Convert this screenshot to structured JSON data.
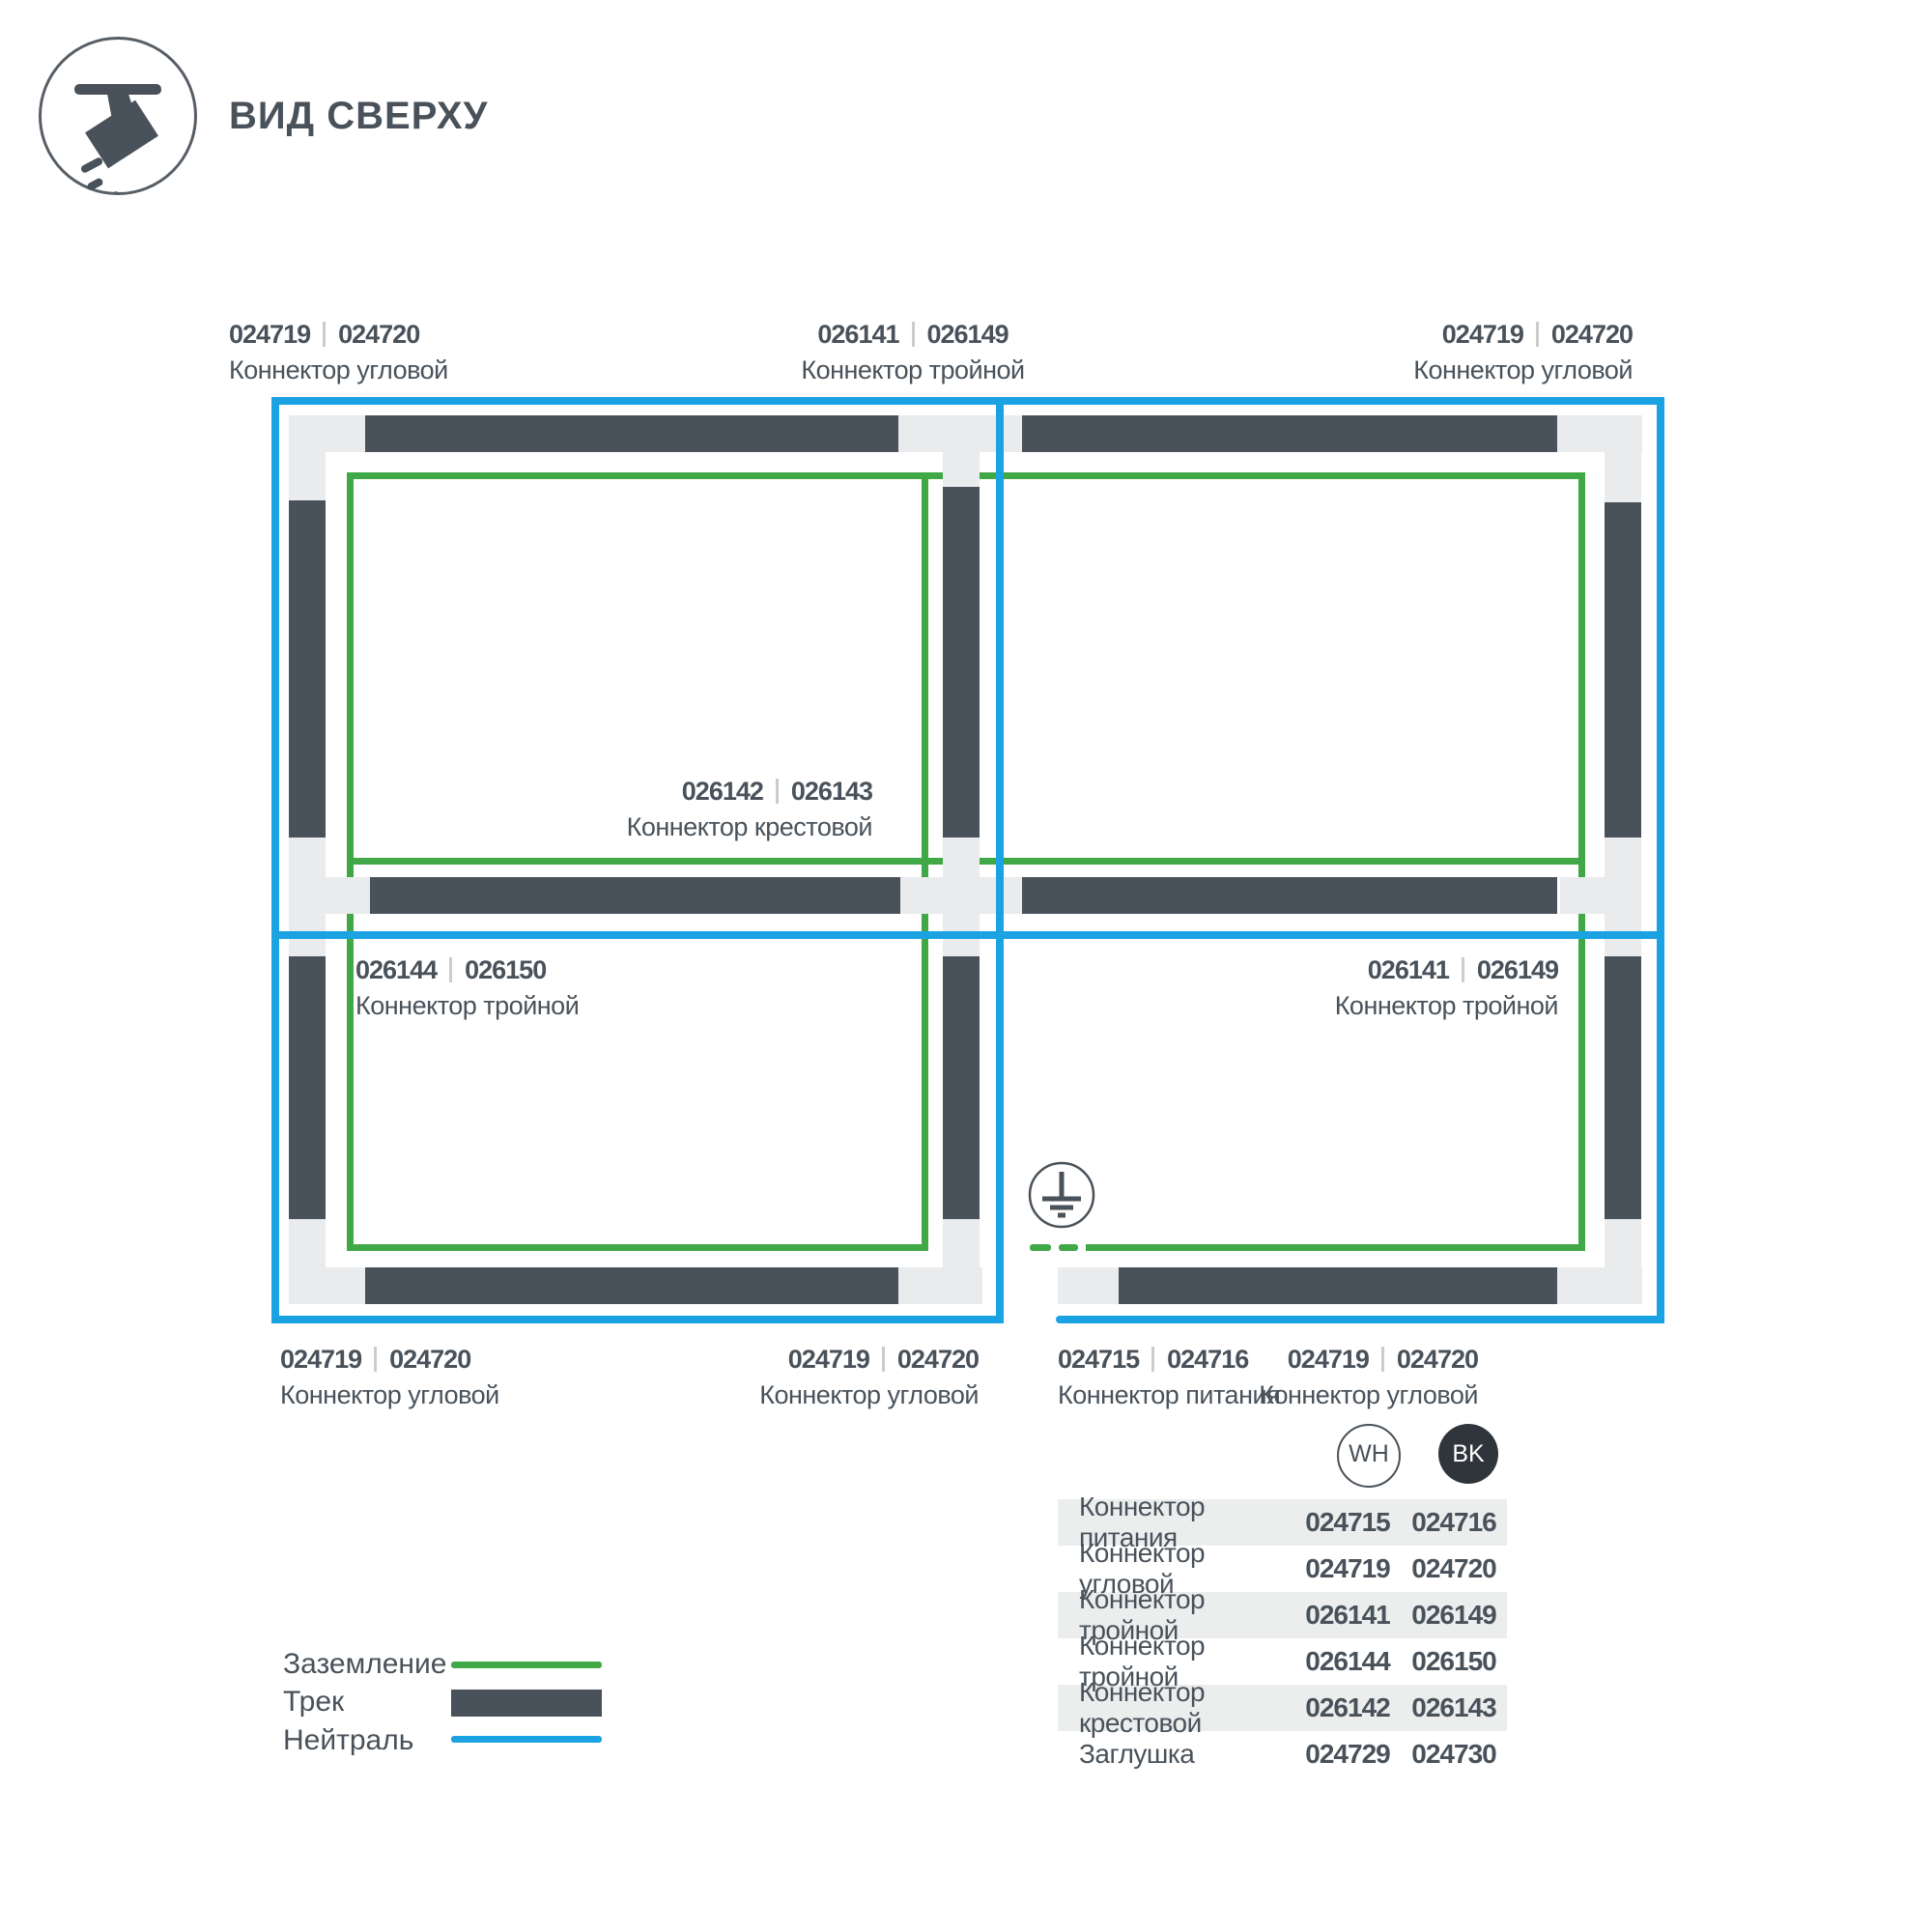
{
  "header": {
    "title": "ВИД СВЕРХУ",
    "icon": "track-spotlight-icon"
  },
  "colors": {
    "track": "#49525A",
    "connector": "#E9EBEC",
    "ground_green": "#41A847",
    "neutral_blue": "#1BA2E2",
    "table_row_gray": "#ECEEEE",
    "bk_chip": "#2F353A"
  },
  "diagram": {
    "labels": [
      {
        "id": "top-left",
        "codes": [
          "024719",
          "024720"
        ],
        "name": "Коннектор угловой"
      },
      {
        "id": "top-center",
        "codes": [
          "026141",
          "026149"
        ],
        "name": "Коннектор тройной"
      },
      {
        "id": "top-right",
        "codes": [
          "024719",
          "024720"
        ],
        "name": "Коннектор угловой"
      },
      {
        "id": "center-cross",
        "codes": [
          "026142",
          "026143"
        ],
        "name": "Коннектор крестовой"
      },
      {
        "id": "mid-left",
        "codes": [
          "026144",
          "026150"
        ],
        "name": "Коннектор тройной"
      },
      {
        "id": "mid-right",
        "codes": [
          "026141",
          "026149"
        ],
        "name": "Коннектор тройной"
      },
      {
        "id": "bottom-left",
        "codes": [
          "024719",
          "024720"
        ],
        "name": "Коннектор угловой"
      },
      {
        "id": "bottom-center",
        "codes": [
          "024719",
          "024720"
        ],
        "name": "Коннектор угловой"
      },
      {
        "id": "bottom-power",
        "codes": [
          "024715",
          "024716"
        ],
        "name": "Коннектор питания"
      },
      {
        "id": "bottom-right",
        "codes": [
          "024719",
          "024720"
        ],
        "name": "Коннектор угловой"
      }
    ],
    "ground_icon": "earth-ground-symbol"
  },
  "legend": {
    "items": [
      {
        "label": "Заземление",
        "swatch": "green-line"
      },
      {
        "label": "Трек",
        "swatch": "dark-bar"
      },
      {
        "label": "Нейтраль",
        "swatch": "blue-line"
      }
    ]
  },
  "table": {
    "columns": [
      {
        "id": "wh",
        "label": "WH"
      },
      {
        "id": "bk",
        "label": "BK"
      }
    ],
    "rows": [
      {
        "name": "Коннектор питания",
        "wh": "024715",
        "bk": "024716"
      },
      {
        "name": "Коннектор угловой",
        "wh": "024719",
        "bk": "024720"
      },
      {
        "name": "Коннектор тройной",
        "wh": "026141",
        "bk": "026149"
      },
      {
        "name": "Коннектор тройной",
        "wh": "026144",
        "bk": "026150"
      },
      {
        "name": "Коннектор крестовой",
        "wh": "026142",
        "bk": "026143"
      },
      {
        "name": "Заглушка",
        "wh": "024729",
        "bk": "024730"
      }
    ]
  }
}
